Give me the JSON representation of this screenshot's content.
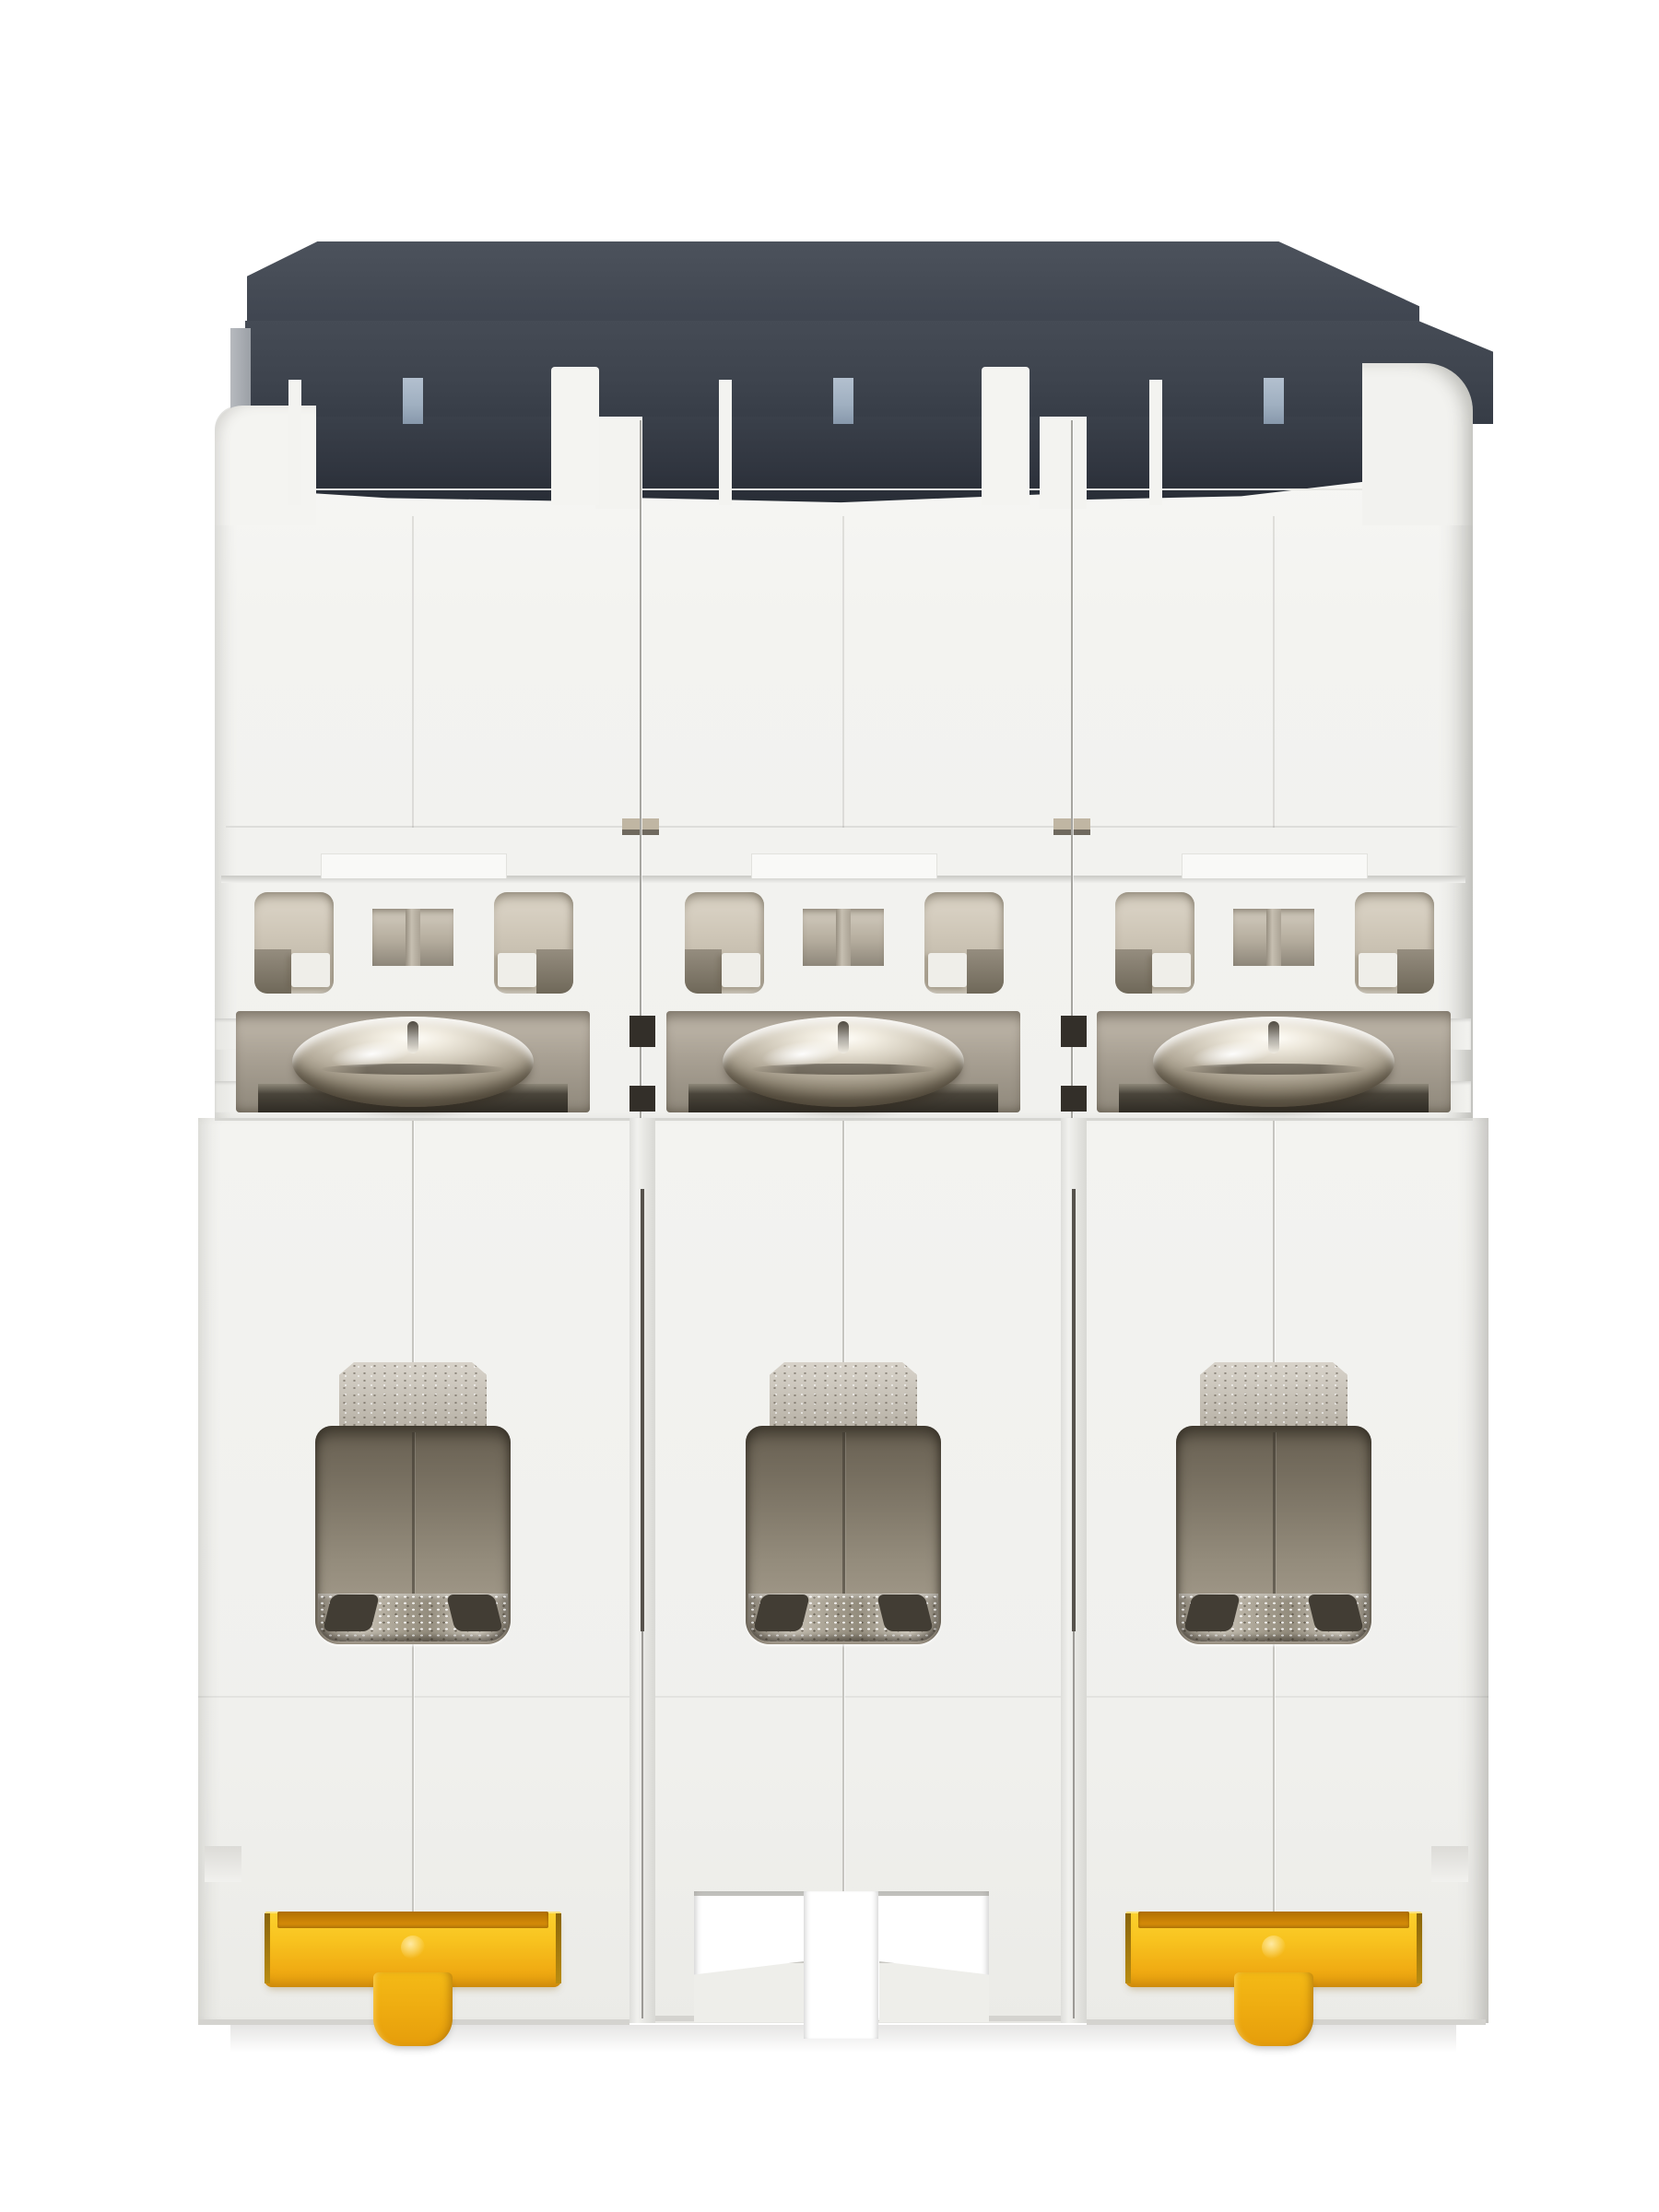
{
  "scene": {
    "type": "product-photo",
    "subject": "Three-pole DIN-rail miniature circuit breaker photographed from the bottom terminal side",
    "background_color": "#ffffff",
    "pole_count": 3,
    "orientation": "upright, three vertical pole modules side by side",
    "materials": "matte white thermoplastic housing, dark grey cap, nickel-plated screws, yellow DIN-rail clips"
  },
  "palette": {
    "background": "#ffffff",
    "housing_white": "#f3f3f0",
    "housing_shadow": "#d6d6d2",
    "cap_dark_grey": "#434954",
    "cap_teeth_dark": "#2c313a",
    "steel_blue_tab": "#a3b1c2",
    "vent_interior_beige": "#cfc7b8",
    "screw_pocket_taupe": "#a9a194",
    "screw_metal_silver": "#d6cfc0",
    "clamp_dark_bronze": "#3b372f",
    "terminal_interior": "#8a8274",
    "terminal_plate_silver": "#c6c0b6",
    "din_clip_yellow": "#f6bf1c",
    "din_clip_orange_recess": "#d98a06",
    "seam_shadow": "#56524c"
  },
  "parts": {
    "device": "Three-pole miniature circuit breaker, bottom view",
    "cap": "Dark grey housing cap (front panel edge of breaker)",
    "cap_left_edge": "Light grey cap end face",
    "blue_tab": "Steel-blue alignment tab",
    "teeth": "Dark cap interlocking teeth",
    "module": "Breaker pole module housing",
    "ledge_tab": "Moulded ledge tab",
    "vent_window": "Arc-vent window showing beige interior",
    "vent_slot": "Centre vent slot with moulded pillar",
    "screw_pocket": "Recessed screw pocket",
    "terminal_screw": "Nickel-plated dome-head terminal screw",
    "clamp": "Terminal clamp plate behind screw",
    "terminal_plate": "Textured metal terminal back plate",
    "terminal_opening": "Wire terminal opening with box clamp cage",
    "terminal_lip": "Metallic clamp lip at opening base",
    "parting_line": "Housing half-shell parting line",
    "seam": "Seam groove between pole modules",
    "din_clip": "Yellow DIN-rail release clip",
    "din_clip_tab": "Yellow DIN-rail clip pull tab",
    "clip_slot": "Empty DIN-rail clip slot of centre pole",
    "floor_shadow": "Soft contact shadow under housing"
  },
  "modules": [
    {
      "id": "pole-1",
      "position": "left",
      "din_clip": "yellow clip fitted"
    },
    {
      "id": "pole-2",
      "position": "centre",
      "din_clip": "empty clip slot"
    },
    {
      "id": "pole-3",
      "position": "right",
      "din_clip": "yellow clip fitted"
    }
  ]
}
